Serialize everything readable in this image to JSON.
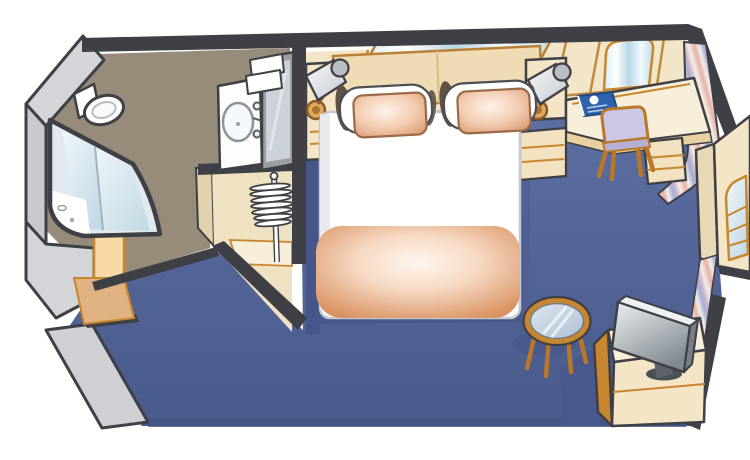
{
  "diagram": {
    "title": "Cruise ship interior stateroom floor plan",
    "type": "cabin-floor-plan",
    "view": "isometric-cutaway"
  },
  "colors": {
    "outline": "#3f4045",
    "wall_gray": "#d4d5d9",
    "wall_gray_dark": "#c2c3c8",
    "carpet_light": "#5d70a3",
    "carpet_dark": "#495a8c",
    "carpet_shadow": "#47568a",
    "bath_floor": "#978b7a",
    "cream_wall": "#f3e6c8",
    "cream_furniture": "#f4e5c6",
    "cream_bright": "#f8efdb",
    "closet_cream": "#efe2c2",
    "closet_side": "#e3d2ae",
    "wood_trim": "#c8872e",
    "headboard_tan": "#f0dcb4",
    "white": "#ffffff",
    "duvet_edge": "#c5c9cf",
    "pillow_shadow": "#5f5244",
    "salmon_edge": "#d89268",
    "blanket_deep": "#d28955",
    "mirror_blue": "#bed7e3",
    "glass_light": "#f0f7fa",
    "book_blue": "#2e62ac",
    "chair_lavender": "#ccc7e3",
    "chair_seat": "#b6afd4",
    "curtain_pink": "#e7b0a5",
    "curtain_blue": "#a3aed4",
    "curtain_cream": "#f3eee6",
    "tv_silver": "#eef1f3",
    "tv_gray": "#818a91",
    "door_face": "#f9d9a6",
    "door_swing": "#e0b181"
  },
  "rooms": [
    {
      "id": "bathroom",
      "label": "Bathroom"
    },
    {
      "id": "closet",
      "label": "Closet"
    },
    {
      "id": "entry",
      "label": "Entry"
    },
    {
      "id": "bedroom",
      "label": "Sleeping area"
    }
  ],
  "furniture": [
    {
      "id": "toilet",
      "label": "Toilet"
    },
    {
      "id": "shower",
      "label": "Corner shower"
    },
    {
      "id": "vanity-sink",
      "label": "Vanity sink"
    },
    {
      "id": "vanity-mirror",
      "label": "Vanity mirror"
    },
    {
      "id": "towels",
      "label": "Folded towels"
    },
    {
      "id": "hangers",
      "label": "Closet hangers"
    },
    {
      "id": "entry-door",
      "label": "Cabin door"
    },
    {
      "id": "queen-bed",
      "label": "Queen bed"
    },
    {
      "id": "pillows",
      "label": "Pillows"
    },
    {
      "id": "headboard-mirror",
      "label": "Mirror above headboard"
    },
    {
      "id": "nightstand-left",
      "label": "Left nightstand"
    },
    {
      "id": "nightstand-right",
      "label": "Right nightstand"
    },
    {
      "id": "reading-lamps",
      "label": "Reading lamps"
    },
    {
      "id": "desk",
      "label": "Desk with drawers"
    },
    {
      "id": "desk-chair",
      "label": "Desk chair"
    },
    {
      "id": "desk-mirror",
      "label": "Mirror above desk"
    },
    {
      "id": "brochure",
      "label": "Cruise brochure"
    },
    {
      "id": "curtain",
      "label": "Striped curtain"
    },
    {
      "id": "wardrobe",
      "label": "Mirrored wardrobe"
    },
    {
      "id": "tv",
      "label": "Television"
    },
    {
      "id": "tv-cabinet",
      "label": "TV cabinet"
    },
    {
      "id": "coffee-table",
      "label": "Round glass table"
    },
    {
      "id": "carpet",
      "label": "Carpet"
    }
  ]
}
